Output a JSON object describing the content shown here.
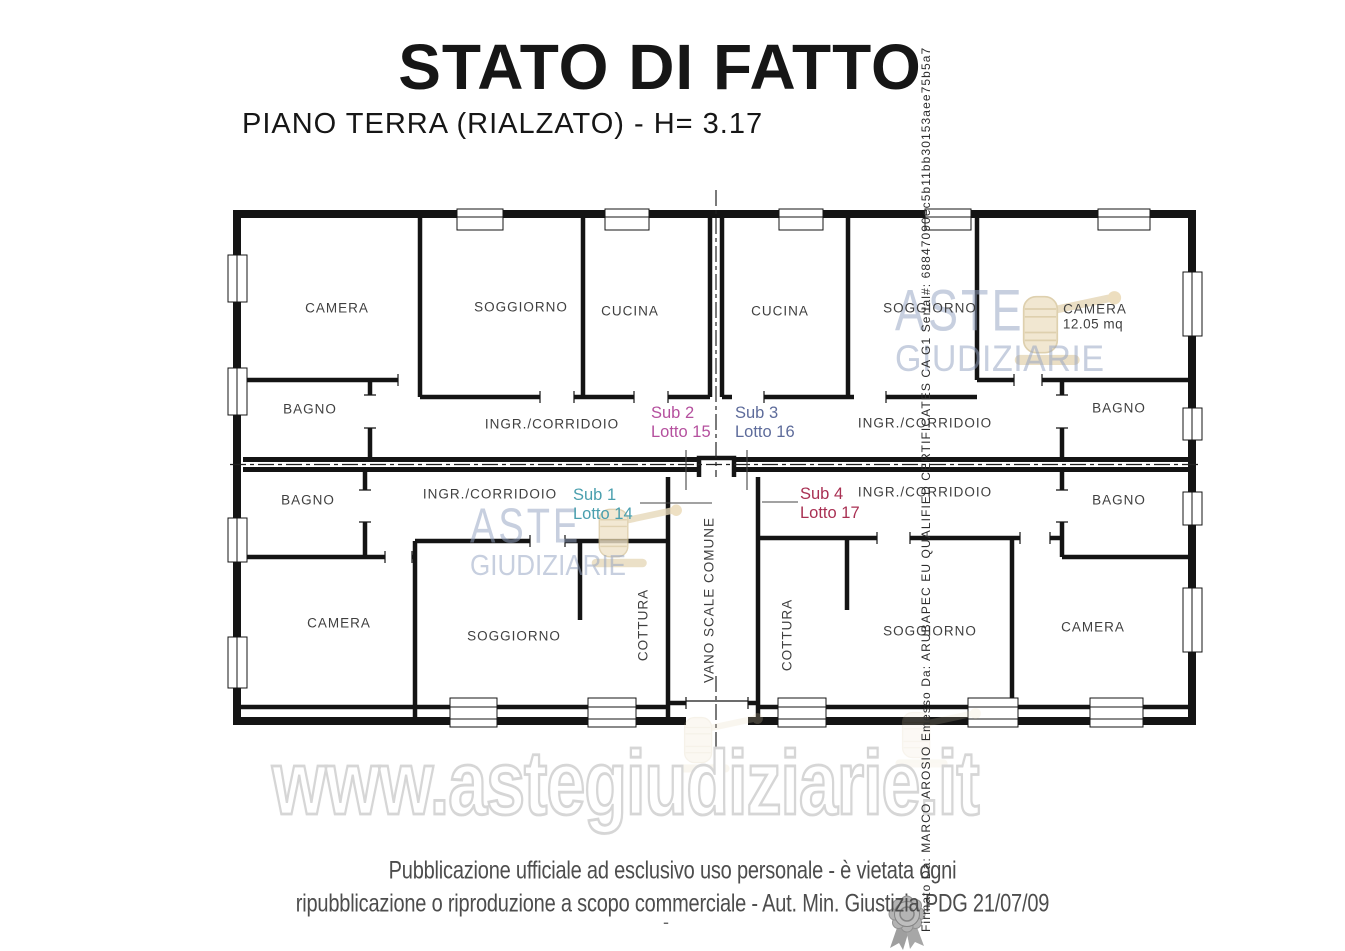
{
  "title": "STATO DI FATTO",
  "subtitle": "PIANO TERRA (RIALZATO) - H= 3.17",
  "plan": {
    "rooms": [
      {
        "label": "CAMERA"
      },
      {
        "label": "SOGGIORNO"
      },
      {
        "label": "CUCINA"
      },
      {
        "label": "CUCINA"
      },
      {
        "label": "SOGGIORNO"
      },
      {
        "label": "CAMERA"
      },
      {
        "label": "BAGNO"
      },
      {
        "label": "INGR./CORRIDOIO"
      },
      {
        "label": "INGR./CORRIDOIO"
      },
      {
        "label": "BAGNO"
      },
      {
        "label": "BAGNO"
      },
      {
        "label": "INGR./CORRIDOIO"
      },
      {
        "label": "INGR./CORRIDOIO"
      },
      {
        "label": "BAGNO"
      },
      {
        "label": "CAMERA"
      },
      {
        "label": "SOGGIORNO"
      },
      {
        "label": "COTTURA"
      },
      {
        "label": "VANO SCALE COMUNE"
      },
      {
        "label": "COTTURA"
      },
      {
        "label": "SOGGIORNO"
      },
      {
        "label": "CAMERA"
      }
    ],
    "camera_area": "12.05 mq",
    "units": [
      {
        "sub": "Sub 1",
        "lotto": "Lotto 14",
        "color": "#4a9fae"
      },
      {
        "sub": "Sub 2",
        "lotto": "Lotto 15",
        "color": "#b5509e"
      },
      {
        "sub": "Sub 3",
        "lotto": "Lotto 16",
        "color": "#5e6c9b"
      },
      {
        "sub": "Sub 4",
        "lotto": "Lotto 17",
        "color": "#a93053"
      }
    ]
  },
  "watermark": {
    "logo_line1": "ASTE",
    "logo_line2": "GIUDIZIARIE",
    "url": "www.astegiudiziarie.it",
    "logo_color": "#96a3c1",
    "gavel_color": "#e7d9ba"
  },
  "signature": "Firmato Da: MARCO AROSIO Emesso Da: ARUBAPEC EU QUALIFIED CERTIFICATES CA G1 Serial#: 68847090ec5b11bb30153aee75b5a7",
  "footer": {
    "line1": "Pubblicazione ufficiale ad esclusivo uso personale - è vietata ogni",
    "line2": "ripubblicazione o riproduzione a scopo commerciale - Aut. Min. Giustizia PDG 21/07/09",
    "mark": "-"
  }
}
